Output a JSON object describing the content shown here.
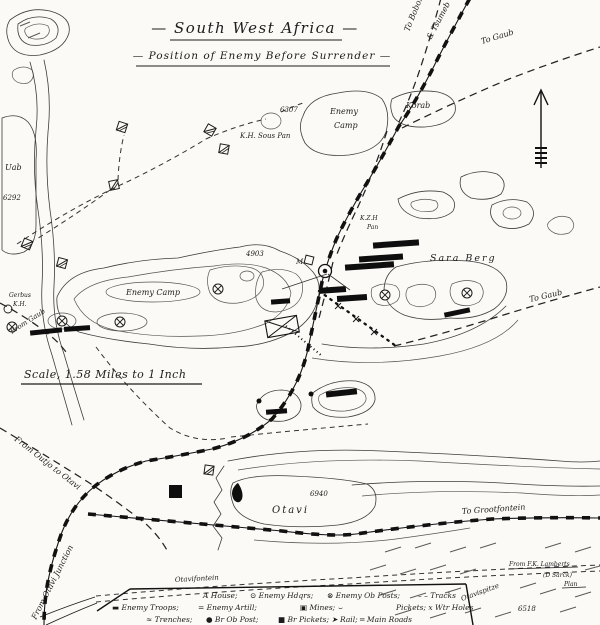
{
  "title": {
    "line1": "— South West Africa —",
    "line2": "— Position of Enemy Before Surrender —"
  },
  "scale_note": "Scale, 1.58 Miles to 1 Inch",
  "routes": {
    "to_bobos": "To Bobos",
    "tsumeb": "& Tsumeb",
    "to_gaub_ne": "To Gaub",
    "to_gaub_e": "To Gaub",
    "from_gaub_w": "From Gaub",
    "from_outjo": "From Outjo to Otavi",
    "from_otavi_junction": "From Otavi Junction",
    "to_grootfontein": "To Grootfontein"
  },
  "places": {
    "enemy_camp_north_1": "Enemy",
    "enemy_camp_north_2": "Camp",
    "korab": "Korab",
    "elev_6307": "6307",
    "kh_sous_pan": "K.H. Sous Pan",
    "uab": "Uab",
    "elev_6292": "6292",
    "gerbus": "Gerbus",
    "gerbus_kh": "K.H.",
    "enemy_camp_central": "Enemy Camp",
    "elev_4903": "4903",
    "m_marker": "M",
    "kzh": "K.Z.H",
    "kzh_pan": "Pan",
    "sara_berg": "Sara Berg",
    "otavi": "Otavi",
    "elev_6940": "6940",
    "otavifontein": "Otavifontein",
    "otavispitze": "Otavispitze",
    "elev_6518": "6518"
  },
  "credit": {
    "line1": "From F.K. Lamberts",
    "line2": "(D Sarck)",
    "line3": "Plan"
  },
  "legend": {
    "house": "A House;",
    "enemy_hdqrs": "⊙ Enemy Hdqrs;",
    "enemy_ob_posts": "⊗ Enemy Ob Posts;",
    "tracks": "– – Tracks",
    "enemy_troops": "▬ Enemy Troops;",
    "enemy_artill": "= Enemy Artill;",
    "mines": "▣ Mines; ⌣",
    "pickets": "Pickets; x Wtr Holes",
    "trenches": "≈ Trenches;",
    "br_ob_post": "● Br Ob Post;",
    "br_pickets": "■ Br Pickets; ➤ Rail; ═ Main Roads"
  },
  "colors": {
    "ink": "#1c1c1c",
    "paper": "#fbfaf6",
    "contour": "#3d3d3d"
  }
}
